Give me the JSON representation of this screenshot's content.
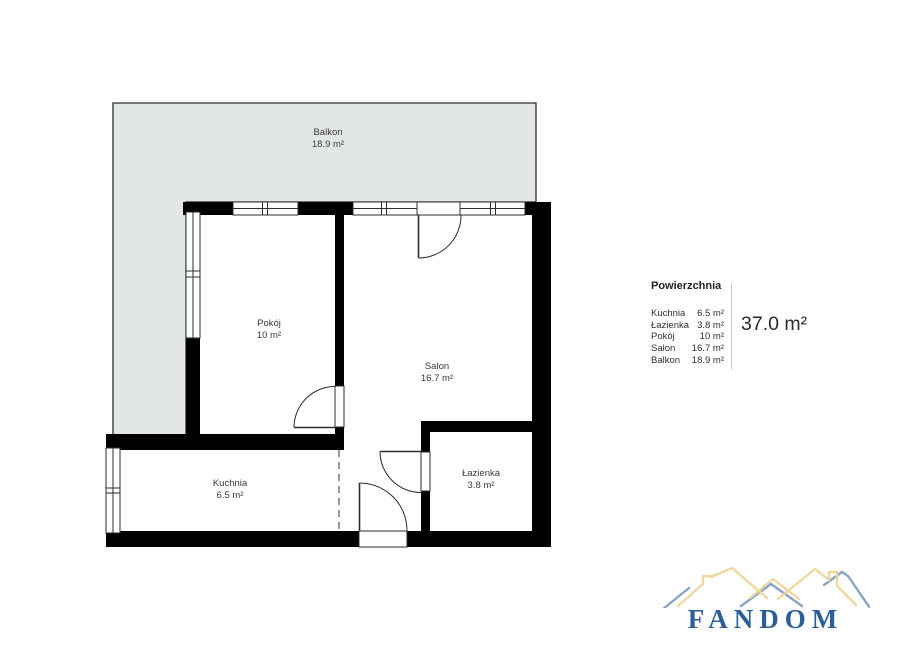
{
  "rooms": [
    {
      "name": "Balkon",
      "area": "18.9 m²"
    },
    {
      "name": "Pokój",
      "area": "10 m²"
    },
    {
      "name": "Salon",
      "area": "16.7 m²"
    },
    {
      "name": "Kuchnia",
      "area": "6.5 m²"
    },
    {
      "name": "Łazienka",
      "area": "3.8 m²"
    }
  ],
  "legend": {
    "header": "Powierzchnia",
    "items": [
      {
        "label": "Kuchnia",
        "value": "6.5 m²"
      },
      {
        "label": "Łazienka",
        "value": "3.8 m²"
      },
      {
        "label": "Pokój",
        "value": "10 m²"
      },
      {
        "label": "Salon",
        "value": "16.7 m²"
      },
      {
        "label": "Balkon",
        "value": "18.9 m²"
      }
    ],
    "total": "37.0 m²"
  },
  "logo": {
    "text": "FANDOM"
  },
  "colors": {
    "wall": "#000000",
    "balcony_fill": "#e3e6e6",
    "outline": "#2e2e2e",
    "dashed": "#555555",
    "logo_blue": "#2c5f99",
    "roof_tan": "#eed7a0",
    "roof_blue": "#8ba3c4"
  }
}
